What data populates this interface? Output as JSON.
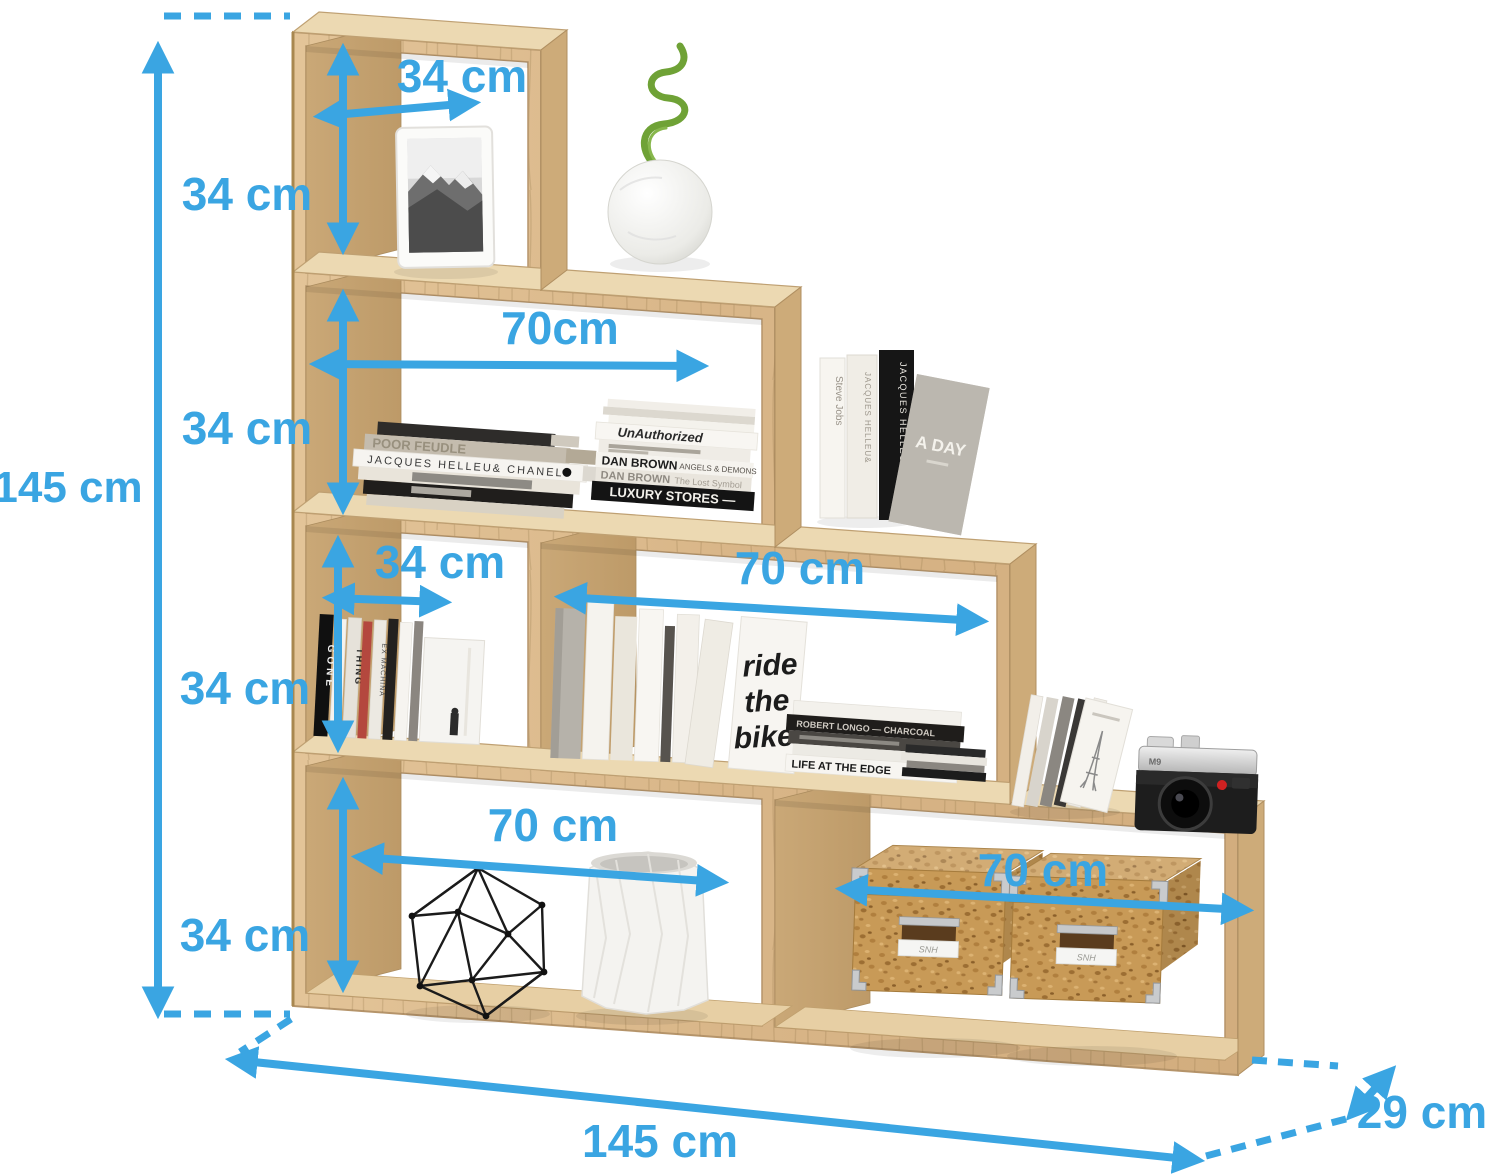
{
  "figure": {
    "type": "furniture dimension diagram",
    "subject": "4-tier staircase step shelf in oak",
    "background": "#ffffff"
  },
  "colors": {
    "dimension_blue": "#3aa5e2",
    "wood_main": "#d9b88a",
    "wood_top": "#ecd9b2",
    "wood_interior": "#c4a271",
    "cork_box": "#c89a57"
  },
  "dimensions": {
    "total_height": "145 cm",
    "total_width": "145 cm",
    "depth": "29 cm",
    "top_cube_width": "34 cm",
    "level1_height": "34 cm",
    "level2_width": "70cm",
    "level2_height": "34 cm",
    "level3_small_width": "34 cm",
    "level3_wide_width": "70 cm",
    "level3_height": "34 cm",
    "bottom_left_width": "70 cm",
    "bottom_right_width": "70 cm",
    "bottom_height": "34 cm"
  },
  "decor": {
    "l2_flat_stack": {
      "poor_feudle": "POOR FEUDLE",
      "jacques_chanel": "JACQUES HELLEU& CHANEL"
    },
    "l2_right_stack": {
      "unauthorized": "UnAuthorized",
      "dan_brown_1": "DAN BROWN",
      "dan_brown_1_title": "ANGELS & DEMONS",
      "dan_brown_2": "DAN BROWN",
      "dan_brown_2_title": "The Lost Symbol",
      "luxury_stores": "LUXURY STORES —"
    },
    "l2_standing": {
      "steve_jobs": "Steve Jobs",
      "jacques_spine": "JACQUES HELLEU&",
      "jacques_black": "JACQUES HELLEU& CHANEL",
      "a_day": "A DAY"
    },
    "l3_dvds": {
      "gone": "GONE",
      "thing": "THING",
      "ex_machina": "EX MACHINA"
    },
    "l3_books": {
      "ride": "ride",
      "the": "the",
      "bike": "bike",
      "charcoal": "ROBERT LONGO — CHARCOAL",
      "life_edge": "LIFE AT THE EDGE"
    },
    "camera_model": "M9",
    "box_label": "SNH"
  }
}
